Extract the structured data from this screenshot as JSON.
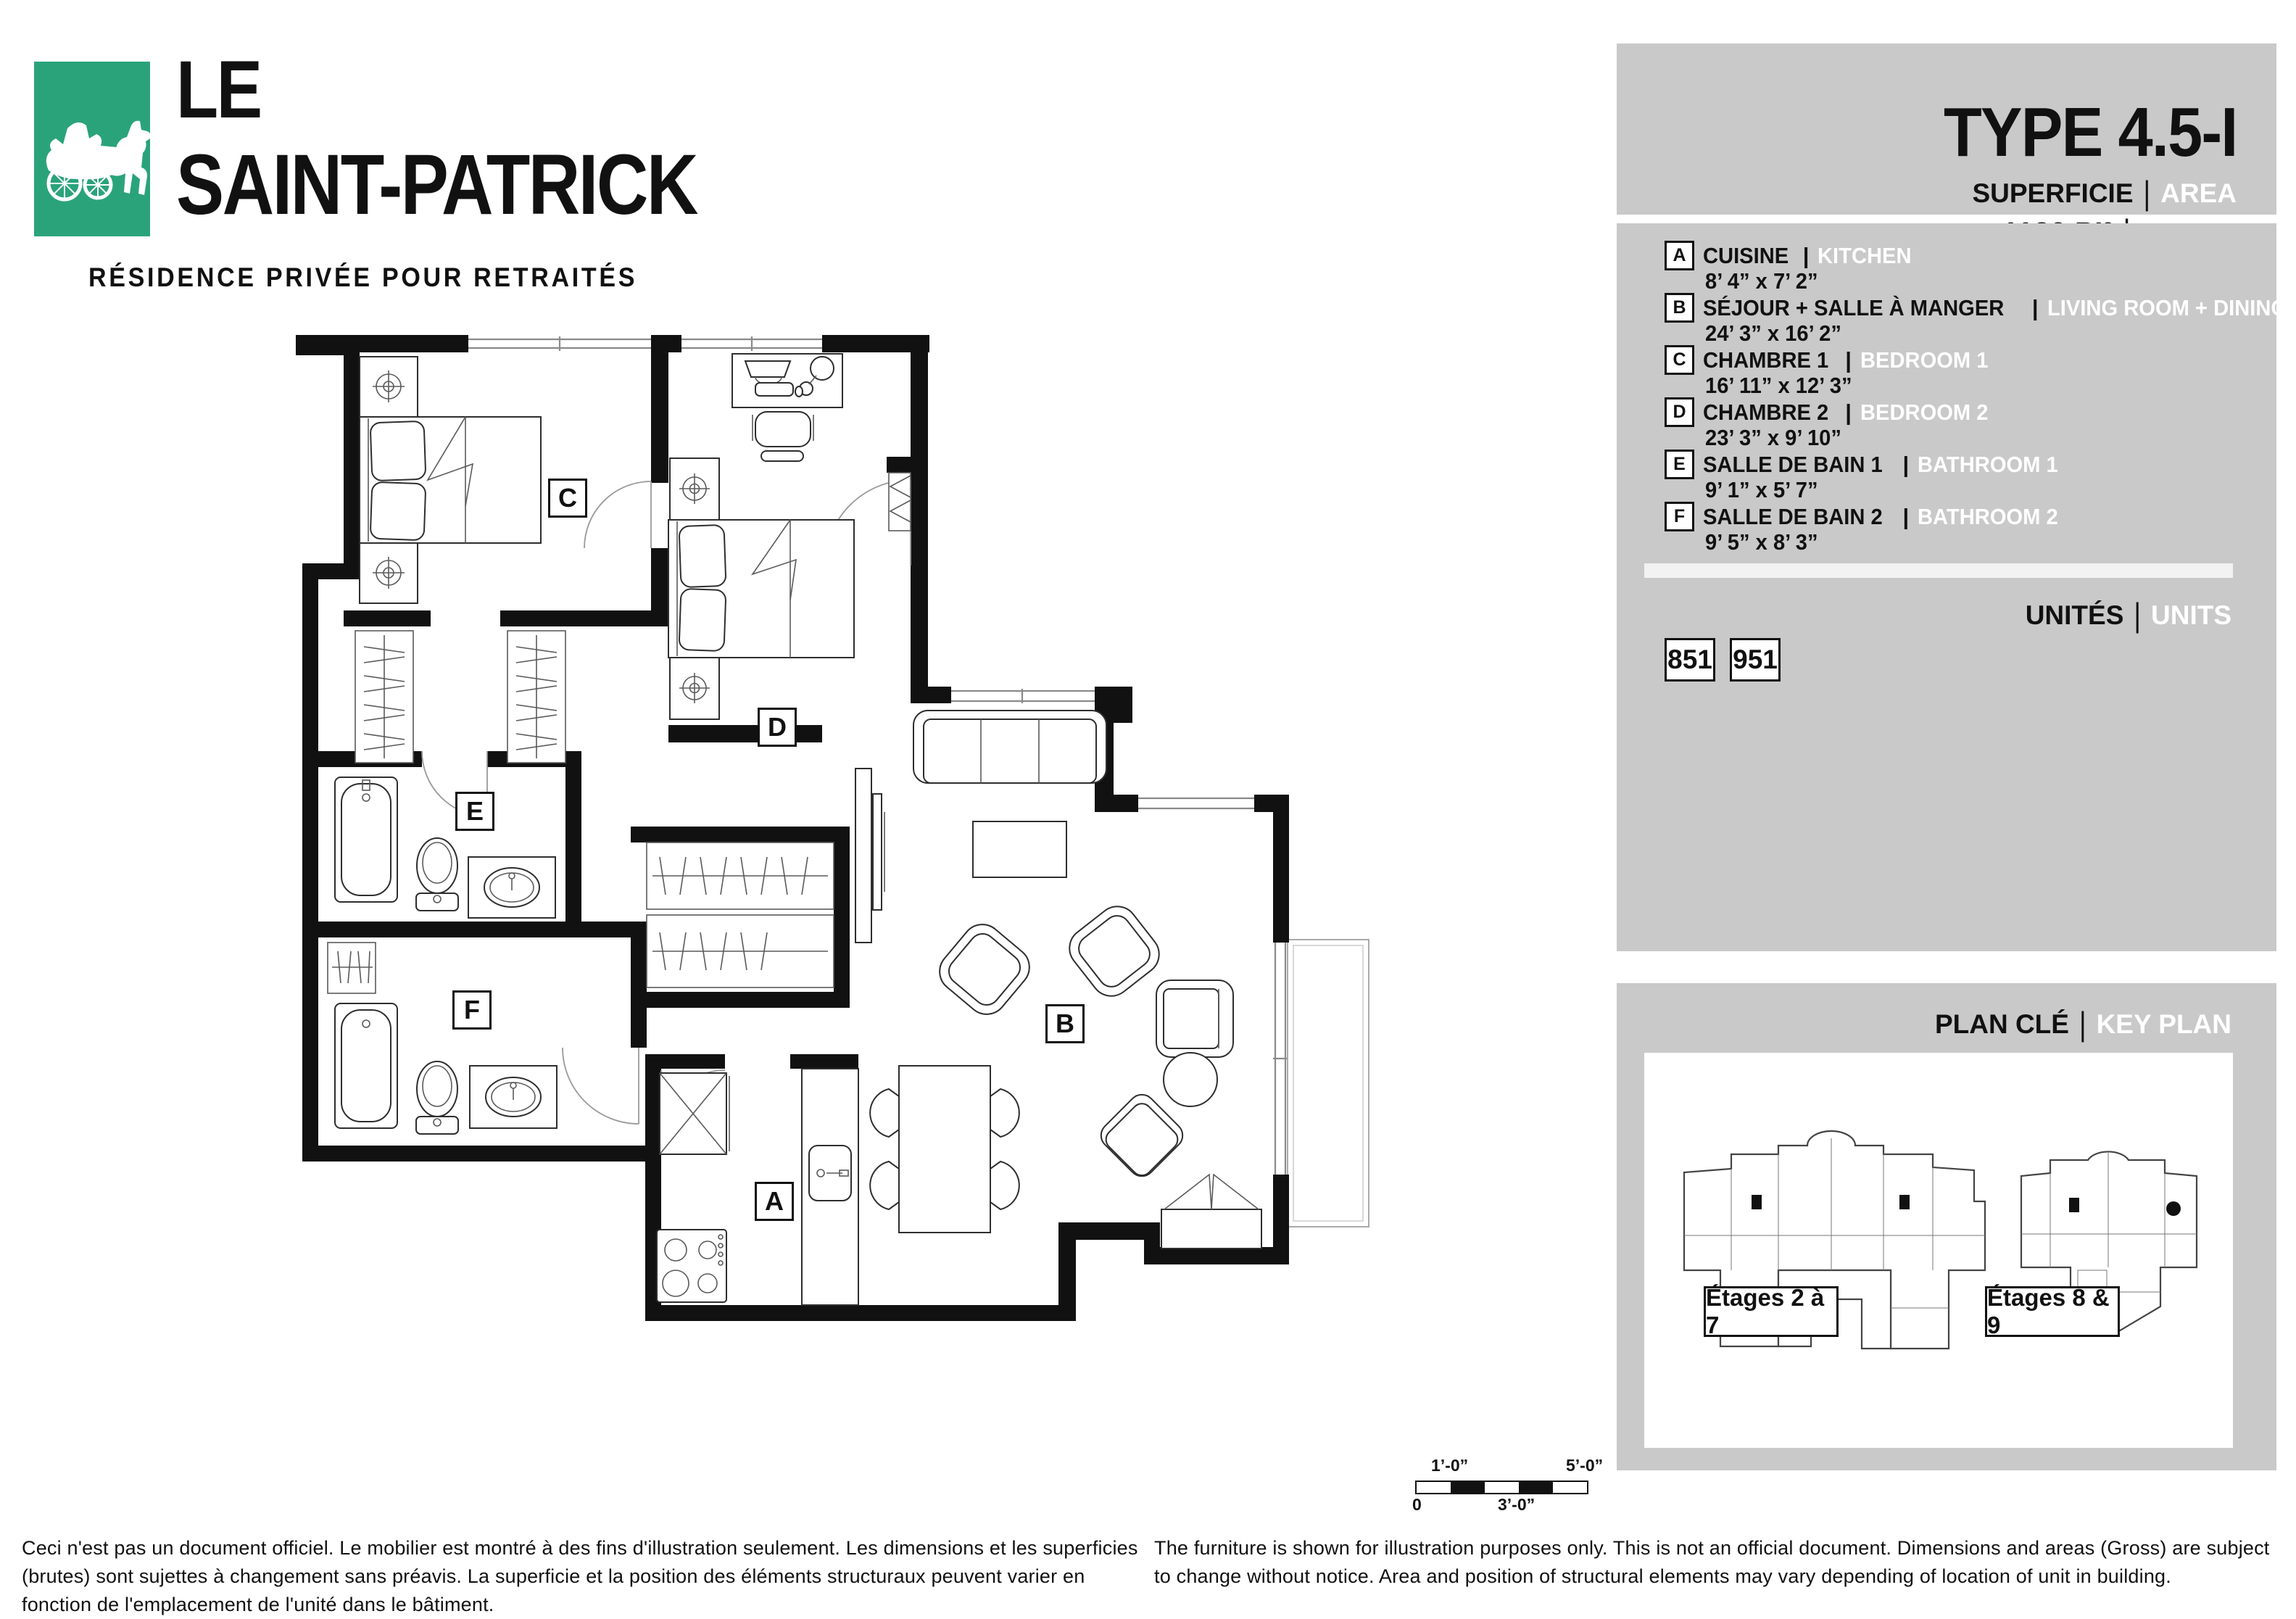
{
  "logo": {
    "line1": "LE",
    "line2": "SAINT-PATRICK",
    "subtitle": "RÉSIDENCE PRIVÉE POUR RETRAITÉS",
    "brand_green": "#2aa37b"
  },
  "header": {
    "phase": "PHASE 2",
    "type": "TYPE 4.5-I",
    "superficie_label": "SUPERFICIE",
    "area_label": "AREA",
    "separator": "|",
    "area_value": "1120 PI²",
    "sqft_label": "SQ. FT"
  },
  "legend": {
    "rooms": [
      {
        "letter": "A",
        "fr": "CUISINE",
        "en": "KITCHEN",
        "dims": "8’ 4” x 7’ 2”"
      },
      {
        "letter": "B",
        "fr": "SÉJOUR + SALLE À MANGER",
        "en": "LIVING ROOM + DINING",
        "dims": "24’ 3” x 16’ 2”"
      },
      {
        "letter": "C",
        "fr": "CHAMBRE 1",
        "en": "BEDROOM 1",
        "dims": "16’ 11” x 12’ 3”"
      },
      {
        "letter": "D",
        "fr": "CHAMBRE 2",
        "en": "BEDROOM 2",
        "dims": "23’ 3” x 9’ 10”"
      },
      {
        "letter": "E",
        "fr": "SALLE DE BAIN 1",
        "en": "BATHROOM 1",
        "dims": "9’ 1” x 5’ 7”"
      },
      {
        "letter": "F",
        "fr": "SALLE DE BAIN 2",
        "en": "BATHROOM 2",
        "dims": "9’ 5” x 8’ 3”"
      }
    ]
  },
  "units": {
    "label_fr": "UNITÉS",
    "label_en": "UNITS",
    "numbers": [
      "851",
      "951"
    ]
  },
  "key_plan": {
    "label_fr": "PLAN CLÉ",
    "label_en": "KEY PLAN",
    "floor_labels": [
      "Étages 2 à 7",
      "Étages 8 & 9"
    ]
  },
  "plan": {
    "room_labels": [
      "A",
      "B",
      "C",
      "D",
      "E",
      "F"
    ]
  },
  "scale_bar": {
    "top_left": "1’-0”",
    "top_right": "5’-0”",
    "bottom_left": "0",
    "bottom_mid": "3’-0”"
  },
  "disclaimers": {
    "fr": "Ceci n'est pas un document officiel. Le mobilier est montré à des fins d'illustration seulement. Les dimensions et les superficies (brutes) sont sujettes à changement sans préavis. La superficie et la position des éléments structuraux peuvent varier en fonction de l'emplacement de l'unité dans le bâtiment.",
    "en": "The furniture is shown for illustration purposes only. This is not an official document. Dimensions and areas (Gross) are subject to change without notice. Area and position of structural elements may vary depending of location of unit in building."
  }
}
